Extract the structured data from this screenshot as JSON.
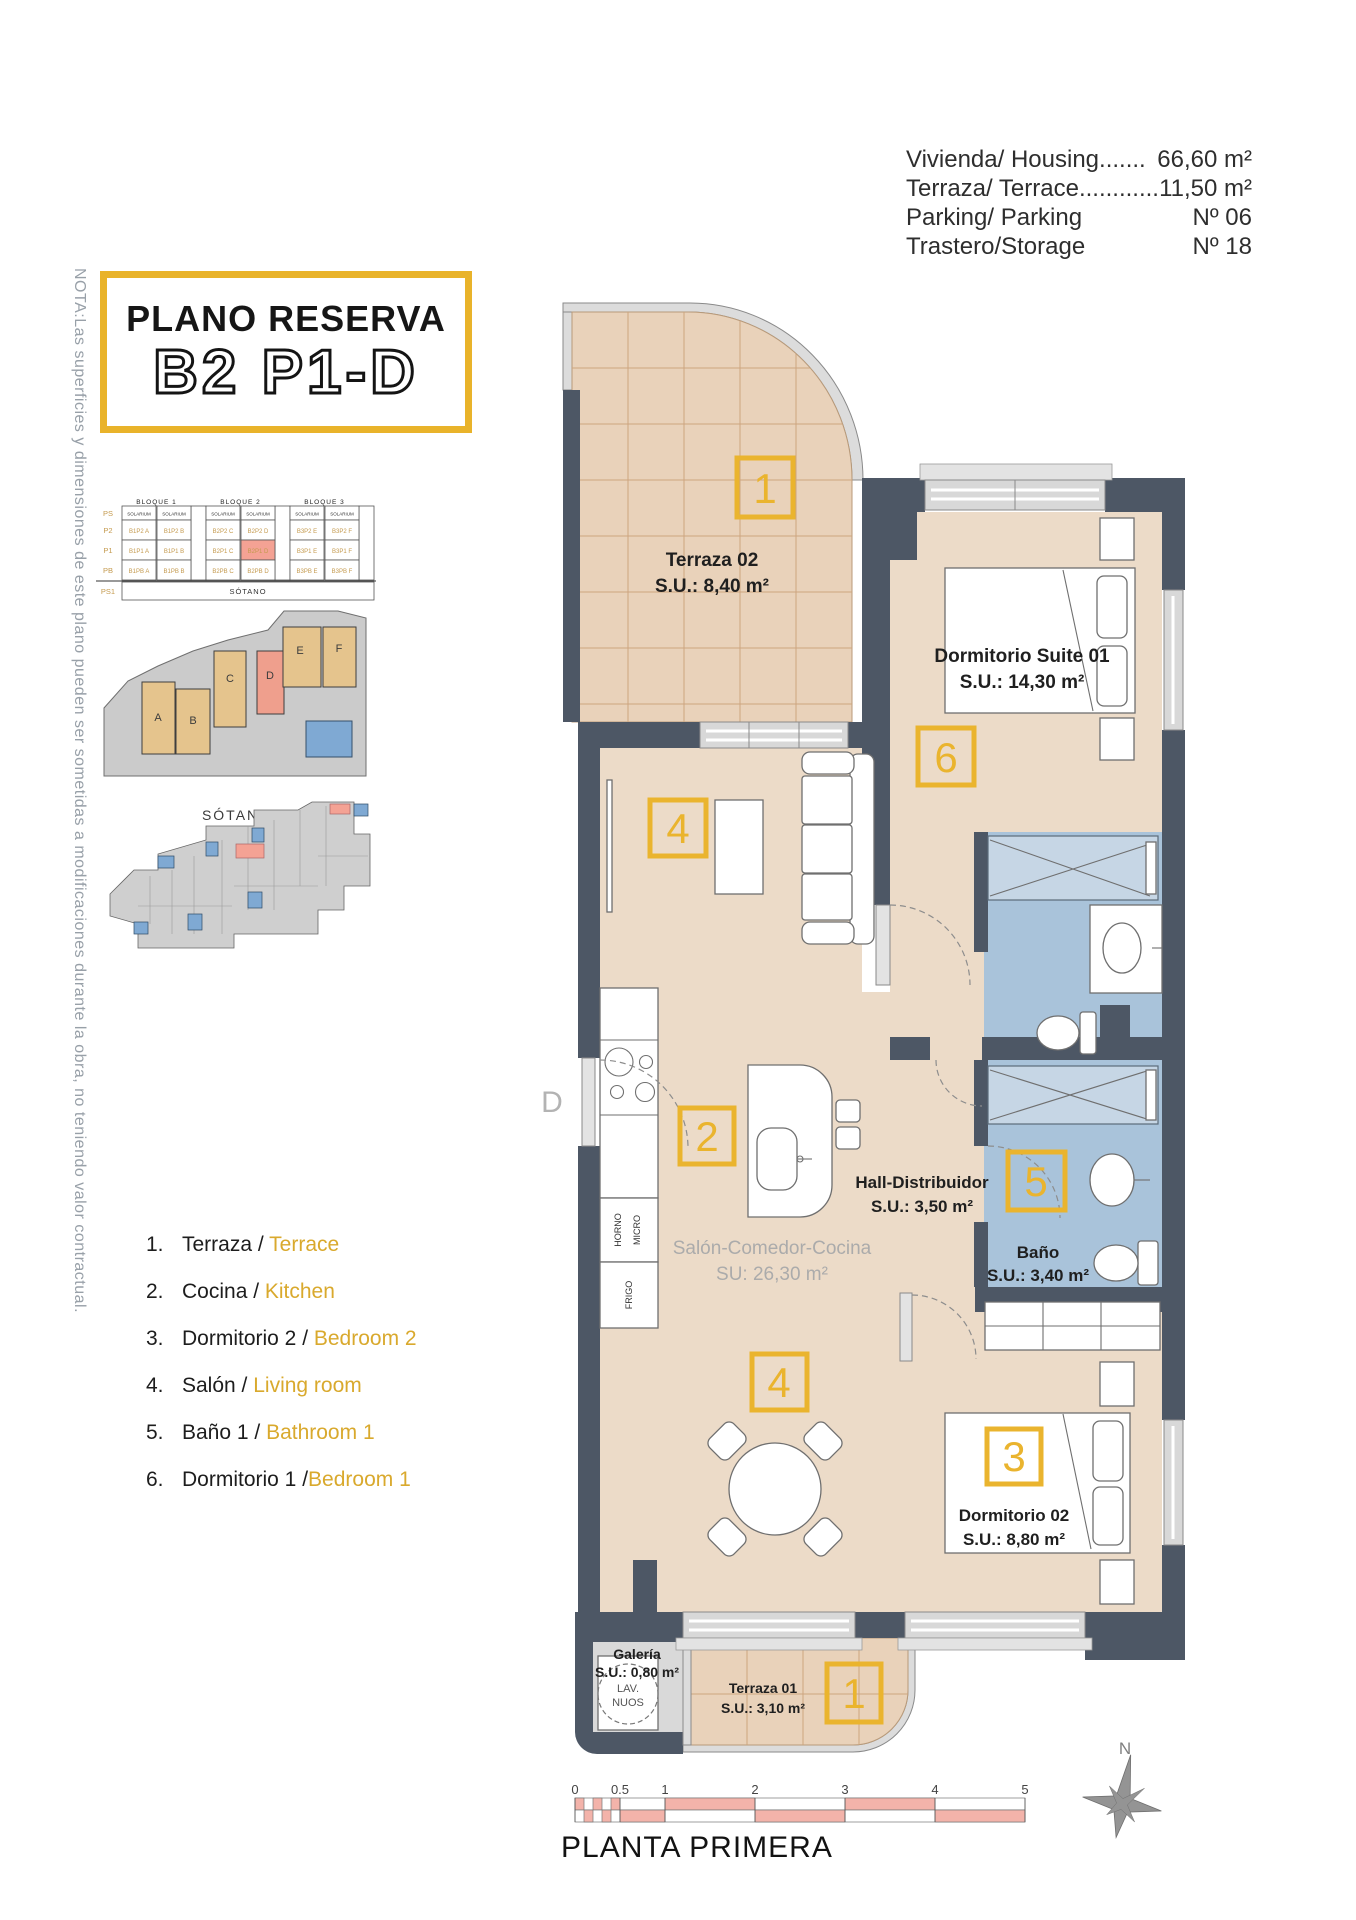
{
  "note_vertical": "NOTA:Las superficies y dimensiones de este plano pueden ser sometidas a modificaciones durante la obra, no teniendo valor contractual.",
  "title": {
    "line1": "PLANO RESERVA",
    "line2": "B2 P1-D"
  },
  "info": {
    "rows": [
      {
        "label": "Vivienda/ Housing.......",
        "value": "66,60 m²"
      },
      {
        "label": "Terraza/ Terrace............",
        "value": "11,50 m²"
      },
      {
        "label": "Parking/ Parking",
        "value": "Nº 06"
      },
      {
        "label": "Trastero/Storage",
        "value": "Nº 18"
      }
    ]
  },
  "elevation": {
    "bloques": [
      "BLOQUE 1",
      "BLOQUE 2",
      "BLOQUE 3"
    ],
    "solarium": "SOLARIUM",
    "floors": [
      "PS",
      "P2",
      "P1",
      "PB",
      "PS1"
    ],
    "sotano": "SÓTANO",
    "cells": {
      "p2": [
        "B1P2 A",
        "B1P2 B",
        "B2P2 C",
        "B2P2 D",
        "B3P2 E",
        "B3P2 F"
      ],
      "p1": [
        "B1P1 A",
        "B1P1 B",
        "B2P1 C",
        "B2P1 D",
        "B3P1 E",
        "B3P1 F"
      ],
      "pb": [
        "B1PB A",
        "B1PB B",
        "B2PB C",
        "B2PB D",
        "B3PB E",
        "B3PB F"
      ]
    },
    "highlighted_unit": "B2P1 D"
  },
  "siteplan": {
    "blocks": [
      "A",
      "B",
      "C",
      "D",
      "E",
      "F"
    ],
    "highlighted_block": "D"
  },
  "sotano_plan": {
    "title": "SÓTANO"
  },
  "legend": {
    "items": [
      {
        "num": "1.",
        "es": "Terraza / ",
        "en": "Terrace"
      },
      {
        "num": "2.",
        "es": "Cocina / ",
        "en": "Kitchen"
      },
      {
        "num": "3.",
        "es": "Dormitorio 2 / ",
        "en": "Bedroom 2"
      },
      {
        "num": "4.",
        "es": "Salón / ",
        "en": "Living room"
      },
      {
        "num": "5.",
        "es": "Baño 1 / ",
        "en": "Bathroom 1"
      },
      {
        "num": "6.",
        "es": "Dormitorio 1 /",
        "en": "Bedroom 1"
      }
    ]
  },
  "plan": {
    "rooms": {
      "terraza02": {
        "name": "Terraza 02",
        "area": "S.U.: 8,40 m²"
      },
      "suite": {
        "name": "Dormitorio Suite 01",
        "area": "S.U.: 14,30 m²"
      },
      "hall": {
        "name": "Hall-Distribuidor",
        "area": "S.U.: 3,50 m²"
      },
      "bano": {
        "name": "Baño",
        "area": "S.U.: 3,40 m²"
      },
      "salon": {
        "name": "Salón-Comedor-Cocina",
        "area": "SU: 26,30 m²"
      },
      "dorm02": {
        "name": "Dormitorio 02",
        "area": "S.U.: 8,80 m²"
      },
      "galeria": {
        "name": "Galería",
        "area": "S.U.: 0,80 m²"
      },
      "terraza01": {
        "name": "Terraza 01",
        "area": "S.U.: 3,10 m²"
      }
    },
    "badges": {
      "terraza02": "1",
      "suite": "6",
      "salon": "4",
      "cocina": "2",
      "bano": "5",
      "comedor": "4",
      "dorm02": "3",
      "terraza01": "1"
    },
    "door_label": "D",
    "appliances": {
      "horno": "HORNO",
      "micro": "MICRO",
      "frigo": "FRIGO",
      "washer1": "LAV.",
      "washer2": "NUOS"
    }
  },
  "scale": {
    "ticks": [
      "0",
      "0.5",
      "1",
      "2",
      "3",
      "4",
      "5"
    ]
  },
  "floor_title": "PLANTA PRIMERA",
  "compass": {
    "n": "N"
  },
  "colors": {
    "accent_yellow": "#eab42e",
    "wall": "#4d5765",
    "floor": "#ecdbc8",
    "bath_floor": "#a9c3da",
    "highlight_salmon": "#f2a294"
  }
}
